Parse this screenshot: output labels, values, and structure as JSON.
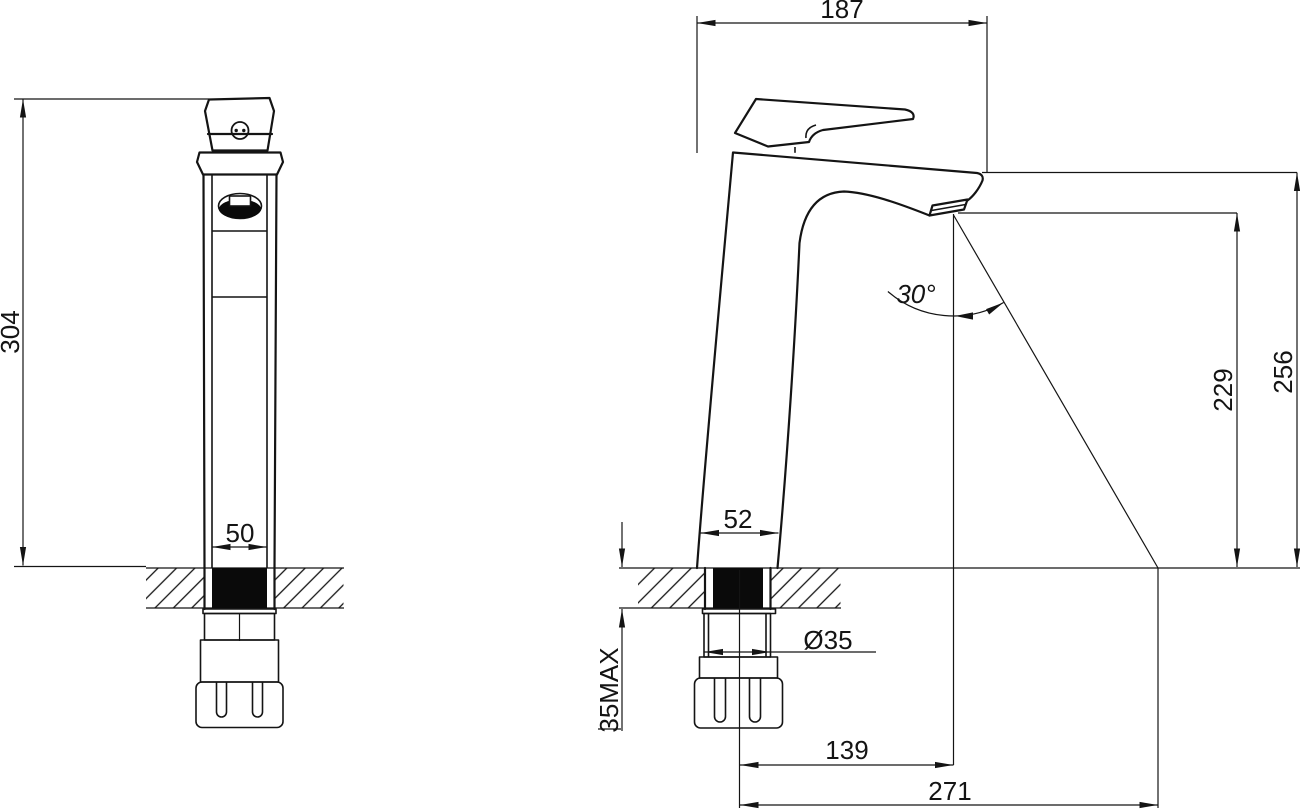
{
  "views": {
    "front": {
      "dims": {
        "height": "304",
        "base_width": "50"
      }
    },
    "side": {
      "dims": {
        "reach": "187",
        "angle": "30°",
        "spout_height": "229",
        "overall_height": "256",
        "base_width": "52",
        "shank_diameter": "Ø35",
        "max_deck": "35MAX",
        "spout_reach": "139",
        "stream_reach": "271"
      }
    }
  }
}
